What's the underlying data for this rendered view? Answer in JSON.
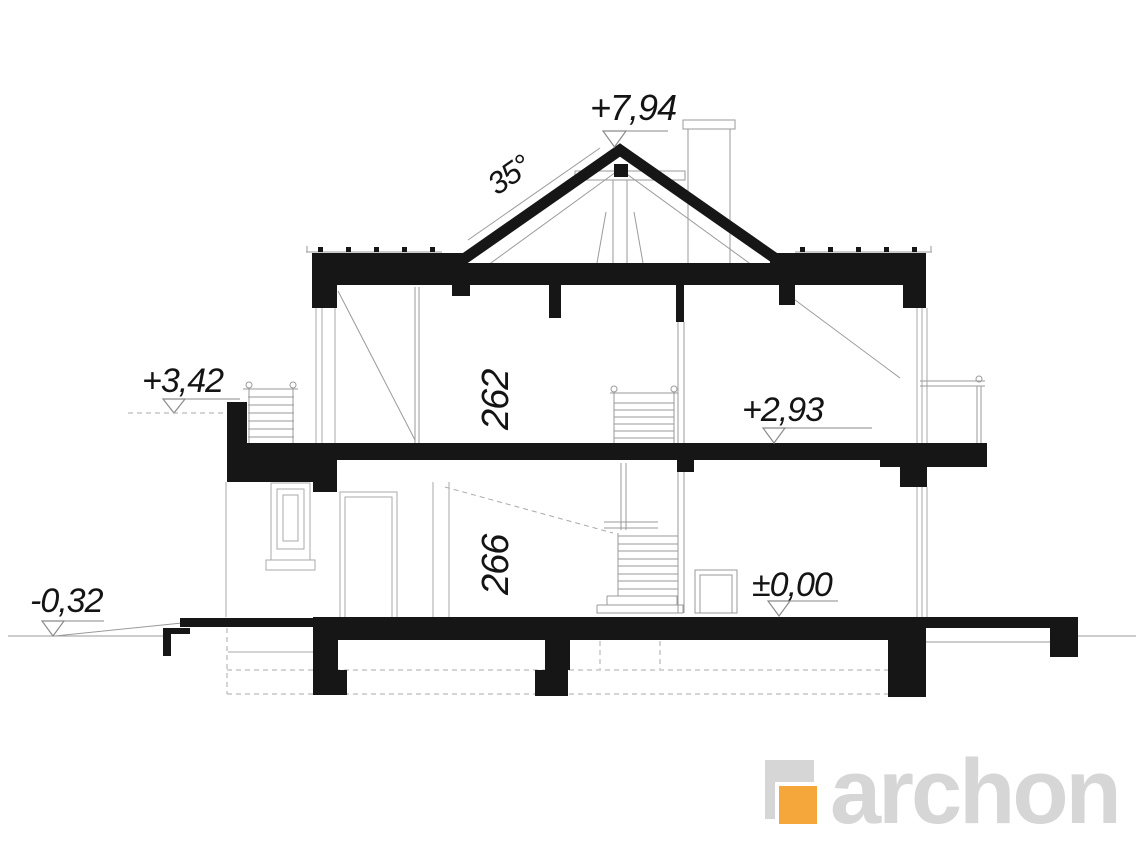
{
  "drawing": {
    "levels": {
      "ridge": "+7,94",
      "roof_angle": "35°",
      "balcony": "+3,42",
      "upper_floor": "+2,93",
      "ground_floor": "±0,00",
      "terrain": "-0,32"
    },
    "room_heights": {
      "upper_floor": "262",
      "ground_floor": "266"
    },
    "colors": {
      "cut_black": "#161616",
      "line_gray": "#9A9A9A"
    }
  },
  "logo": {
    "text": "archon",
    "gray": "#D6D6D6",
    "orange": "#F5A73B"
  }
}
